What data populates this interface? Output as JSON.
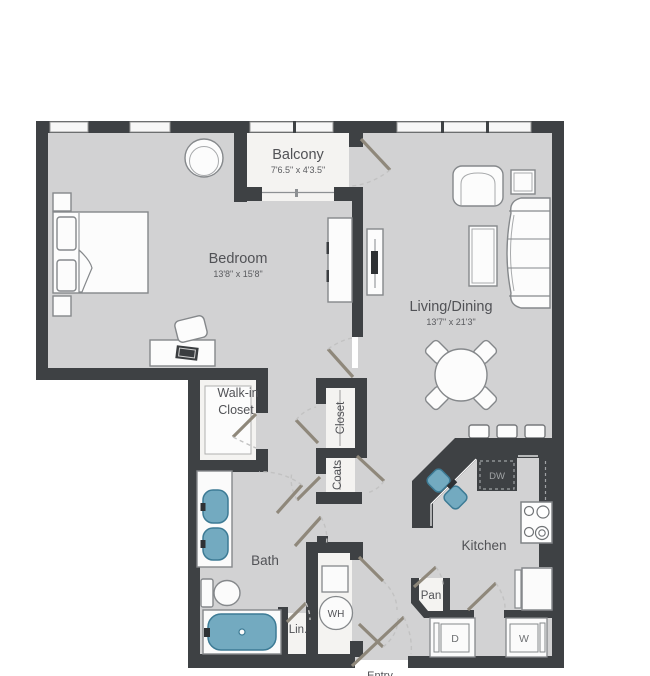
{
  "rooms": {
    "balcony": {
      "name": "Balcony",
      "dims": "7'6.5\" x 4'3.5\""
    },
    "bedroom": {
      "name": "Bedroom",
      "dims": "13'8\" x 15'8\""
    },
    "living_dining": {
      "name": "Living/Dining",
      "dims": "13'7\" x 21'3\""
    },
    "walk_in_closet": {
      "line1": "Walk-in",
      "line2": "Closet"
    },
    "hall_closet": {
      "name": "Closet"
    },
    "coats_closet": {
      "name": "Coats"
    },
    "bath": {
      "name": "Bath"
    },
    "kitchen": {
      "name": "Kitchen"
    },
    "pantry": {
      "name": "Pan"
    },
    "linen": {
      "name": "Lin."
    },
    "entry": {
      "name": "Entry"
    }
  },
  "appliances": {
    "dishwasher": "DW",
    "water_heater": "WH",
    "dryer": "D",
    "washer": "W"
  },
  "colors": {
    "wall": "#3e4144",
    "floor": "#d2d2d3",
    "fixture_blue": "#73aac0",
    "fixture_blue_border": "#3d7b95",
    "door_leaf": "#8f887b",
    "label_text": "#515256"
  }
}
